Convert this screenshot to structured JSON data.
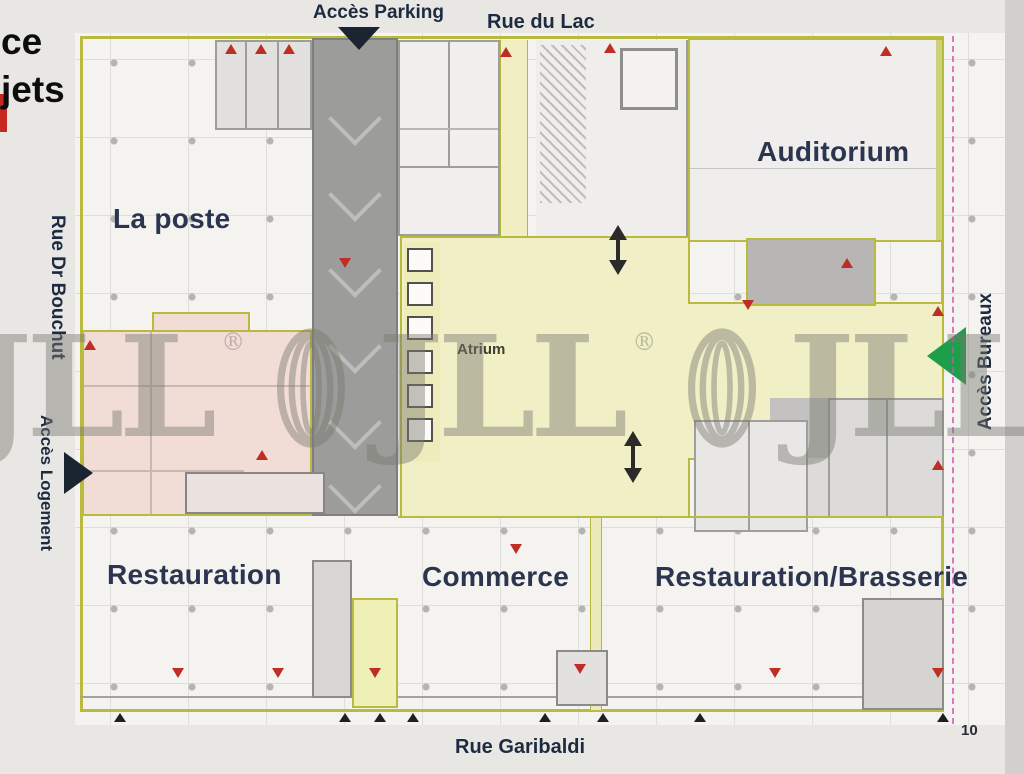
{
  "fragments": {
    "line1": "ce",
    "line2": "jets"
  },
  "streets": {
    "acces_parking": "Accès Parking",
    "rue_du_lac": "Rue du Lac",
    "rue_dr_bouchut": "Rue Dr Bouchut",
    "acces_logement": "Accès Logement",
    "acces_bureaux": "Accès Bureaux",
    "rue_garibaldi": "Rue Garibaldi"
  },
  "zones": {
    "la_poste": "La poste",
    "auditorium": "Auditorium",
    "atrium": "Atrium",
    "restauration": "Restauration",
    "commerce": "Commerce",
    "restauration_brasserie": "Restauration/Brasserie"
  },
  "page_number": "10",
  "watermark": {
    "text": "JLL",
    "registered": "®"
  },
  "colors": {
    "street_label": "#1d2b40",
    "zone_label": "#2c3550",
    "atrium_fill": "#f1efc5",
    "corridor_fill": "#f0eec2",
    "pink_fill": "#f2ddd6",
    "ramp_fill": "#9c9c9a",
    "building_border": "#b9bb3e",
    "exit_marker": "#bf2e25",
    "access_arrow_dark": "#1b2531",
    "access_arrow_green": "#1d9e4b",
    "boundary_magenta": "#cf4fb8",
    "watermark_gray": "#7a7a72"
  }
}
